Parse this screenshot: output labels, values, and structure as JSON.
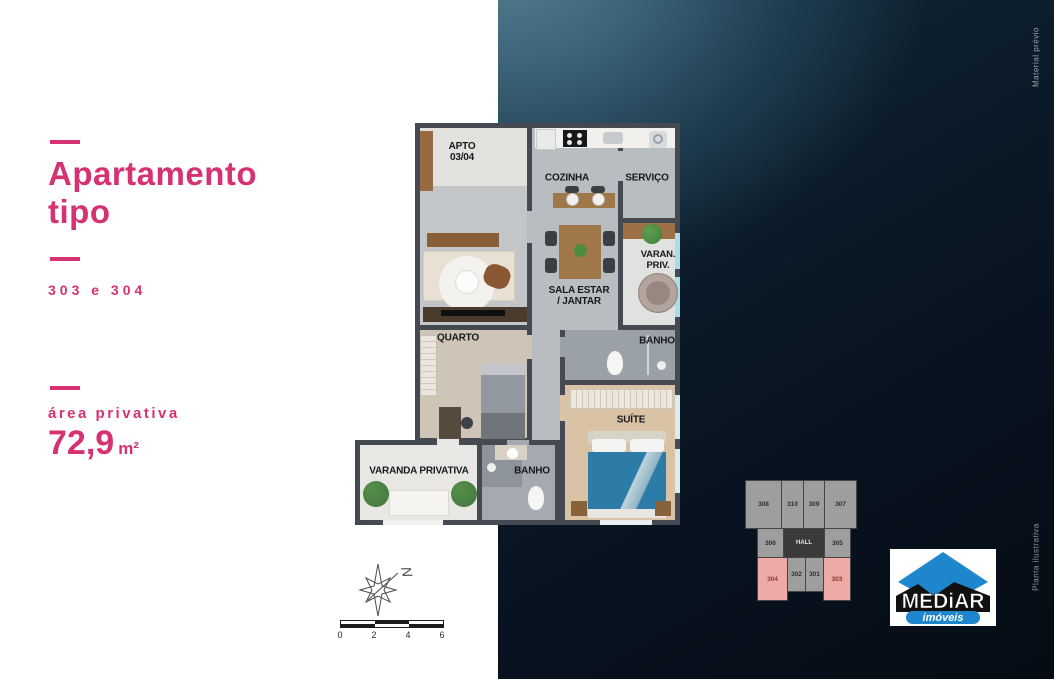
{
  "left_panel": {
    "title_line1": "Apartamento",
    "title_line2": "tipo",
    "units_label": "303 e 304",
    "area_label": "área privativa",
    "area_value": "72,9",
    "area_unit": "m²",
    "accent_color": "#d63172"
  },
  "floor_plan": {
    "apto_line1": "APTO",
    "apto_line2": "03/04",
    "rooms": {
      "cozinha": "COZINHA",
      "servico": "SERVIÇO",
      "sala_line1": "SALA ESTAR",
      "sala_line2": "/ JANTAR",
      "varan_line1": "VARAN.",
      "varan_line2": "PRIV.",
      "banho_right": "BANHO",
      "quarto": "QUARTO",
      "suite": "SUÍTE",
      "varanda": "VARANDA PRIVATIVA",
      "banho_bottom": "BANHO"
    }
  },
  "compass": {
    "north_letter": "N"
  },
  "scale_bar": {
    "ticks": [
      "0",
      "2",
      "4",
      "6"
    ]
  },
  "key_plan": {
    "top_row": [
      "308",
      "310",
      "309",
      "307"
    ],
    "middle_row": [
      "306",
      "HALL",
      "305"
    ],
    "bottom_row": [
      "304",
      "302",
      "301",
      "303"
    ],
    "highlighted_units": [
      "304",
      "303"
    ],
    "unit_color": "#9e9e9e",
    "highlight_color": "#eeaaa6"
  },
  "logo": {
    "name": "MEDiAR",
    "tagline": "imóveis",
    "blue": "#1d86cc"
  },
  "side_notes": {
    "top": "Material prévio",
    "bottom": "Planta ilustrativa"
  }
}
